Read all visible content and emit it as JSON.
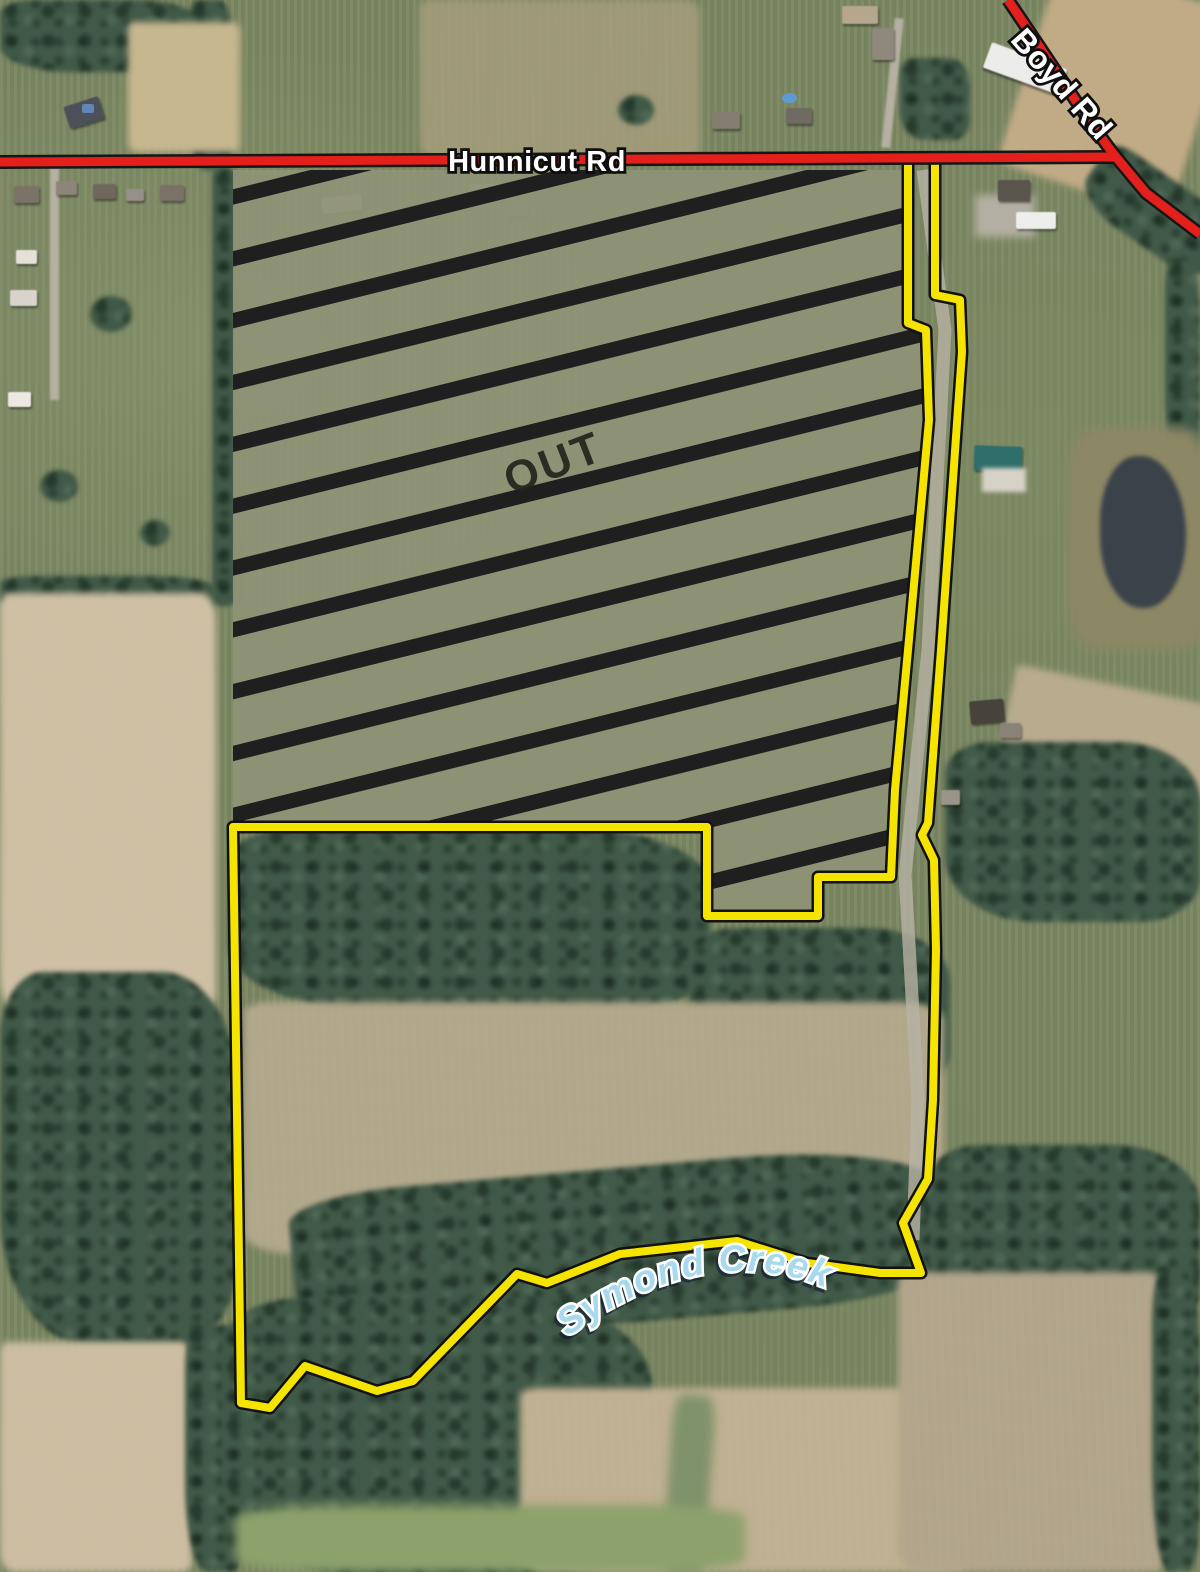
{
  "title": "Aerial parcel map with auction tract boundary",
  "labels": {
    "hunnicut_road": "Hunnicut Rd",
    "boyd_road": "Boyd Rd",
    "out_area": "OUT",
    "creek": "Symond Creek"
  },
  "colors": {
    "parcel_boundary_yellow": "#f5e400",
    "boundary_casing_black": "#111111",
    "road_red": "#e3201b",
    "road_casing_black": "#161616",
    "hatch_stripe_black": "rgba(15,15,18,0.88)",
    "excluded_field_olive": "#8f9376",
    "creek_label_blue": "#a9d9ec",
    "road_label_white": "#ffffff",
    "out_label_dark": "#24241e"
  },
  "geometry": {
    "parcel_boundary_points": "908,162 908,323 926,330 929,420 908,650 895,790 891,877 818,877 818,916 707,916 707,827 233,827 241,1403 270,1408 305,1366 377,1391 413,1381 517,1274 547,1283 620,1254 737,1241 807,1263 880,1273 921,1273 903,1223 928,1179 933,1100 936,950 934,860 922,835 928,823 941,650 962,352 960,300 935,295 935,162",
    "excluded_area_points": "233,170 908,170 908,323 926,330 929,420 908,650 895,790 891,877 818,877 818,916 707,916 707,827 233,827",
    "hunnicut_road_path": "M 0 162 L 1116 157",
    "boyd_road_path": "M 1008 0 C 1042 50 1094 130 1116 157 L 1146 193 L 1200 234",
    "farm_lane_path": "M 923 170 L 945 330 L 928 650 L 905 875 L 918 1100 L 913 1240",
    "creek_label_path": "M 566 1338 Q 700 1238 824 1287"
  },
  "hatch": {
    "angle_deg": -14,
    "period_px": 60,
    "stripe_px": 15
  }
}
